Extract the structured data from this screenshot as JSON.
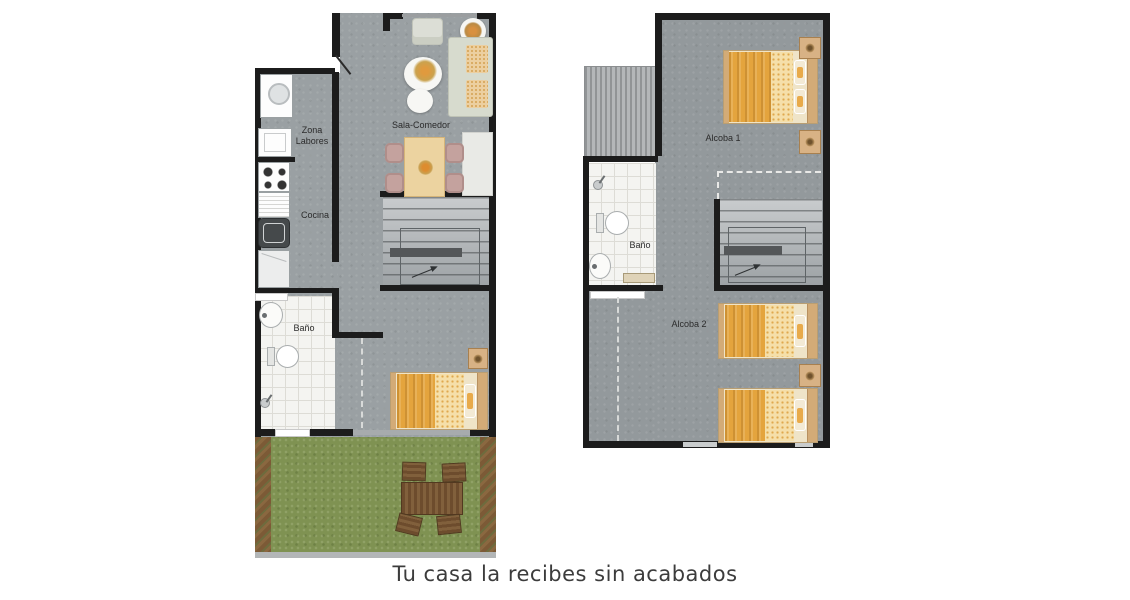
{
  "caption": "Tu casa la recibes sin acabados",
  "floor1": {
    "zona_labores_line1": "Zona",
    "zona_labores_line2": "Labores",
    "sala_comedor": "Sala-Comedor",
    "cocina": "Cocina",
    "bano": "Baño"
  },
  "floor2": {
    "alcoba_1": "Alcoba 1",
    "bano": "Baño",
    "alcoba_2": "Alcoba 2"
  },
  "colors": {
    "wall": "#1c1c1c",
    "floor_concrete_1": "#9aa0a3",
    "floor_concrete_2": "#93999c",
    "bathroom_tile": "#f4f4f1",
    "grass": "#7f9252",
    "soil_border": "#7c5a36",
    "bed_blanket_orange": "#e4a43d",
    "bed_sheet_pattern": "#f5dfa9",
    "light_wood": "#ecd3a0",
    "chair_pink": "#c4a29e",
    "outdoor_wood": "#6d4c2d",
    "caption_text": "#3c3c3c"
  }
}
